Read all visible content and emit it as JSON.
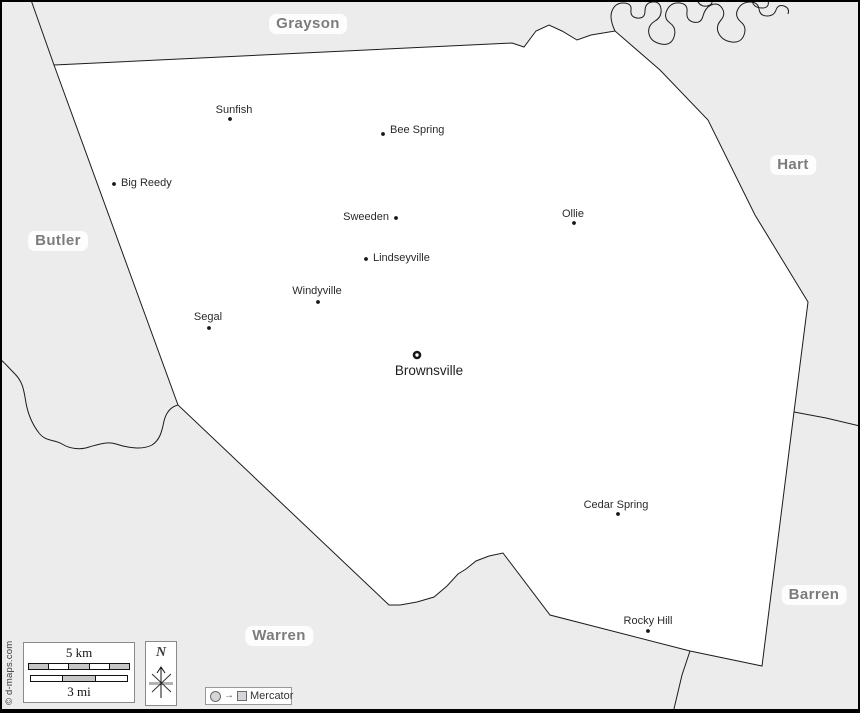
{
  "map": {
    "region_labels": [
      {
        "name": "Grayson",
        "x": 308,
        "y": 24
      },
      {
        "name": "Hart",
        "x": 793,
        "y": 165
      },
      {
        "name": "Butler",
        "x": 58,
        "y": 241
      },
      {
        "name": "Warren",
        "x": 279,
        "y": 636
      },
      {
        "name": "Barren",
        "x": 814,
        "y": 595
      }
    ],
    "county_seat": {
      "name": "Brownsville",
      "dot": [
        417,
        355
      ],
      "label": [
        429,
        371
      ]
    },
    "towns": [
      {
        "name": "Sunfish",
        "dot": [
          230,
          119
        ],
        "label": [
          234,
          110
        ],
        "anchor": "center"
      },
      {
        "name": "Bee Spring",
        "dot": [
          383,
          134
        ],
        "label": [
          390,
          130
        ],
        "anchor": "right"
      },
      {
        "name": "Big Reedy",
        "dot": [
          114,
          184
        ],
        "label": [
          121,
          183
        ],
        "anchor": "right"
      },
      {
        "name": "Sweeden",
        "dot": [
          396,
          218
        ],
        "label": [
          389,
          217
        ],
        "anchor": "left"
      },
      {
        "name": "Ollie",
        "dot": [
          574,
          223
        ],
        "label": [
          573,
          214
        ],
        "anchor": "center"
      },
      {
        "name": "Lindseyville",
        "dot": [
          366,
          259
        ],
        "label": [
          373,
          258
        ],
        "anchor": "right"
      },
      {
        "name": "Windyville",
        "dot": [
          318,
          302
        ],
        "label": [
          317,
          291
        ],
        "anchor": "center"
      },
      {
        "name": "Segal",
        "dot": [
          209,
          328
        ],
        "label": [
          208,
          317
        ],
        "anchor": "center"
      },
      {
        "name": "Cedar Spring",
        "dot": [
          618,
          514
        ],
        "label": [
          616,
          505
        ],
        "anchor": "center"
      },
      {
        "name": "Rocky Hill",
        "dot": [
          648,
          631
        ],
        "label": [
          648,
          621
        ],
        "anchor": "center"
      }
    ]
  },
  "legend": {
    "scale_km": "5 km",
    "scale_mi": "3 mi",
    "north": "N",
    "projection": "Mercator",
    "copyright": "© d-maps.com"
  },
  "colors": {
    "background": "#ececec",
    "county_fill": "#ffffff",
    "border_line": "#1c1c1c",
    "region_label": "#7c7c7c",
    "scale_segment": "#c7c7c7"
  }
}
